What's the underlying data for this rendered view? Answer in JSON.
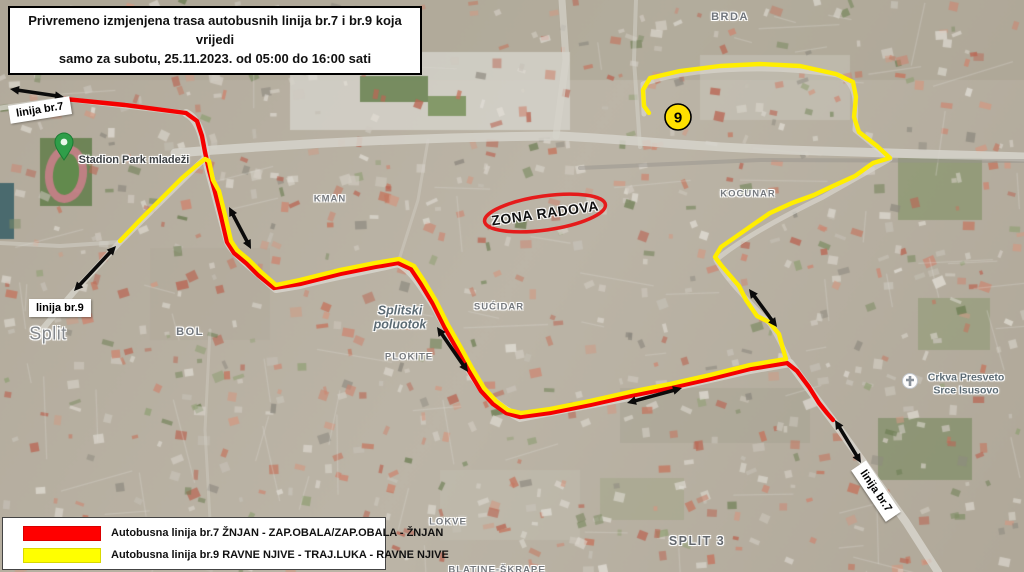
{
  "title": {
    "line1": "Privremeno izmjenjena trasa autobusnih linija br.7 i br.9 koja vrijedi",
    "line2": "samo za subotu, 25.11.2023. od 05:00 do 16:00 sati"
  },
  "legend": {
    "items": [
      {
        "color": "#ff0000",
        "label": "Autobusna linija br.7 ŽNJAN - ZAP.OBALA/ZAP.OBALA - ŽNJAN"
      },
      {
        "color": "#ffff00",
        "label": "Autobusna linija br.9 RAVNE NJIVE - TRAJ.LUKA - RAVNE NJIVE"
      }
    ]
  },
  "callouts": {
    "linija7_top": "linija br.7",
    "linija9": "linija br.9",
    "linija7_bottom": "linija br.7",
    "zona_radova": "ZONA RADOVA"
  },
  "stop_marker": {
    "label": "9",
    "x": 678,
    "y": 117,
    "r": 13,
    "fill": "#ffe000",
    "stroke": "#000"
  },
  "work_zone": {
    "cx": 545,
    "cy": 213,
    "rx": 61,
    "ry": 17,
    "rotation": -8,
    "color": "#e51b1b"
  },
  "map_labels": [
    {
      "text": "BRDA",
      "x": 730,
      "y": 17,
      "cls": "district"
    },
    {
      "text": "KOCUNAR",
      "x": 748,
      "y": 194,
      "cls": "district-sm"
    },
    {
      "text": "KMAN",
      "x": 330,
      "y": 199,
      "cls": "district-sm"
    },
    {
      "text": "SUĆIDAR",
      "x": 499,
      "y": 307,
      "cls": "district-sm"
    },
    {
      "text": "BOL",
      "x": 190,
      "y": 332,
      "cls": "district"
    },
    {
      "text": "PLOKITE",
      "x": 409,
      "y": 357,
      "cls": "district-sm"
    },
    {
      "text": "LOKVE",
      "x": 448,
      "y": 522,
      "cls": "district-sm"
    },
    {
      "text": "SPLIT 3",
      "x": 697,
      "y": 541,
      "cls": "district-lg"
    },
    {
      "text": "BLATINE-ŠKRAPE",
      "x": 497,
      "y": 570,
      "cls": "district-sm"
    },
    {
      "text": "Split",
      "x": 48,
      "y": 334,
      "cls": "city"
    },
    {
      "text": "Splitski poluotok",
      "x": 400,
      "y": 318,
      "cls": "nature"
    },
    {
      "text": "Stadion Park mladeži",
      "x": 134,
      "y": 160,
      "cls": "poi"
    },
    {
      "text": "Crkva Presveto Srce Isusovo",
      "x": 966,
      "y": 384,
      "cls": "poi-church"
    }
  ],
  "routes": [
    {
      "id": "route-br7",
      "name": "Autobusna linija br.7",
      "color": "#f50000",
      "width": 4.4,
      "points": [
        [
          65,
          99
        ],
        [
          125,
          105
        ],
        [
          186,
          113
        ],
        [
          197,
          121
        ],
        [
          202,
          136
        ],
        [
          205,
          152
        ],
        [
          209,
          170
        ],
        [
          215,
          192
        ],
        [
          221,
          216
        ],
        [
          227,
          242
        ],
        [
          234,
          253
        ],
        [
          246,
          263
        ],
        [
          258,
          275
        ],
        [
          274,
          288
        ],
        [
          300,
          284
        ],
        [
          340,
          274
        ],
        [
          375,
          267
        ],
        [
          398,
          263
        ],
        [
          411,
          269
        ],
        [
          421,
          284
        ],
        [
          433,
          304
        ],
        [
          445,
          328
        ],
        [
          457,
          349
        ],
        [
          469,
          371
        ],
        [
          481,
          391
        ],
        [
          493,
          404
        ],
        [
          506,
          413
        ],
        [
          520,
          417
        ],
        [
          550,
          413
        ],
        [
          590,
          405
        ],
        [
          630,
          396
        ],
        [
          670,
          388
        ],
        [
          710,
          379
        ],
        [
          750,
          369
        ],
        [
          787,
          363
        ],
        [
          797,
          371
        ],
        [
          809,
          387
        ],
        [
          819,
          403
        ],
        [
          827,
          413
        ],
        [
          833,
          420
        ]
      ]
    },
    {
      "id": "route-br9",
      "name": "Autobusna linija br.9",
      "color": "#ffee00",
      "width": 4.4,
      "points": [
        [
          120,
          241
        ],
        [
          140,
          220
        ],
        [
          162,
          198
        ],
        [
          182,
          178
        ],
        [
          196,
          166
        ],
        [
          205,
          159
        ],
        [
          209,
          161
        ],
        [
          213,
          180
        ],
        [
          219,
          191
        ],
        [
          225,
          215
        ],
        [
          231,
          241
        ],
        [
          237,
          250
        ],
        [
          249,
          260
        ],
        [
          261,
          272
        ],
        [
          276,
          285
        ],
        [
          300,
          280
        ],
        [
          340,
          270
        ],
        [
          375,
          263
        ],
        [
          399,
          259
        ],
        [
          414,
          266
        ],
        [
          424,
          281
        ],
        [
          436,
          301
        ],
        [
          448,
          325
        ],
        [
          460,
          346
        ],
        [
          472,
          368
        ],
        [
          484,
          388
        ],
        [
          496,
          401
        ],
        [
          508,
          410
        ],
        [
          521,
          413
        ],
        [
          550,
          409
        ],
        [
          590,
          401
        ],
        [
          630,
          392
        ],
        [
          670,
          384
        ],
        [
          710,
          375
        ],
        [
          750,
          365
        ],
        [
          786,
          359
        ],
        [
          783,
          349
        ],
        [
          779,
          334
        ],
        [
          769,
          322
        ],
        [
          757,
          316
        ],
        [
          746,
          300
        ],
        [
          739,
          286
        ],
        [
          721,
          265
        ],
        [
          715,
          257
        ],
        [
          721,
          247
        ],
        [
          734,
          238
        ],
        [
          754,
          224
        ],
        [
          770,
          213
        ],
        [
          792,
          203
        ],
        [
          814,
          195
        ],
        [
          833,
          186
        ],
        [
          855,
          176
        ],
        [
          873,
          163
        ],
        [
          890,
          158
        ],
        [
          877,
          146
        ],
        [
          859,
          132
        ],
        [
          854,
          117
        ],
        [
          856,
          97
        ],
        [
          853,
          82
        ],
        [
          836,
          74
        ],
        [
          800,
          66
        ],
        [
          760,
          64
        ],
        [
          720,
          66
        ],
        [
          680,
          71
        ],
        [
          650,
          78
        ],
        [
          643,
          90
        ],
        [
          644,
          106
        ],
        [
          649,
          113
        ]
      ]
    }
  ],
  "arrows": [
    {
      "x1": 10,
      "y1": 89,
      "x2": 64,
      "y2": 97
    },
    {
      "x1": 116,
      "y1": 246,
      "x2": 74,
      "y2": 291
    },
    {
      "x1": 229,
      "y1": 207,
      "x2": 251,
      "y2": 249
    },
    {
      "x1": 437,
      "y1": 327,
      "x2": 468,
      "y2": 372
    },
    {
      "x1": 627,
      "y1": 403,
      "x2": 682,
      "y2": 388
    },
    {
      "x1": 749,
      "y1": 289,
      "x2": 777,
      "y2": 327
    },
    {
      "x1": 835,
      "y1": 420,
      "x2": 861,
      "y2": 463
    }
  ]
}
